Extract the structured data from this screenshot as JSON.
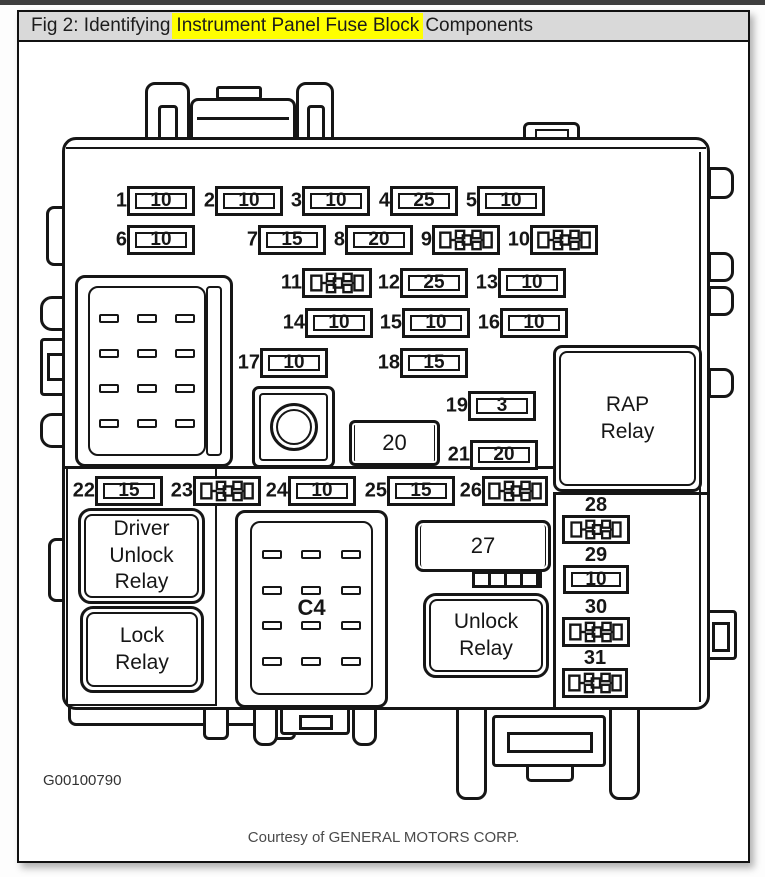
{
  "titlebar": {
    "prefix": "Fig 2: Identifying",
    "highlight": "Instrument Panel Fuse Block",
    "suffix": "Components",
    "highlight_color": "#ffff00"
  },
  "components": [
    {
      "num": "1",
      "amp": "10",
      "type": "fuse"
    },
    {
      "num": "2",
      "amp": "10",
      "type": "fuse"
    },
    {
      "num": "3",
      "amp": "10",
      "type": "fuse"
    },
    {
      "num": "4",
      "amp": "25",
      "type": "fuse"
    },
    {
      "num": "5",
      "amp": "10",
      "type": "fuse"
    },
    {
      "num": "6",
      "amp": "10",
      "type": "fuse"
    },
    {
      "num": "7",
      "amp": "15",
      "type": "fuse"
    },
    {
      "num": "8",
      "amp": "20",
      "type": "fuse"
    },
    {
      "num": "9",
      "type": "circuit-breaker"
    },
    {
      "num": "10",
      "type": "circuit-breaker"
    },
    {
      "num": "11",
      "type": "circuit-breaker"
    },
    {
      "num": "12",
      "amp": "25",
      "type": "fuse"
    },
    {
      "num": "13",
      "amp": "10",
      "type": "fuse"
    },
    {
      "num": "14",
      "amp": "10",
      "type": "fuse"
    },
    {
      "num": "15",
      "amp": "10",
      "type": "fuse"
    },
    {
      "num": "16",
      "amp": "10",
      "type": "fuse"
    },
    {
      "num": "17",
      "amp": "10",
      "type": "fuse"
    },
    {
      "num": "18",
      "amp": "15",
      "type": "fuse"
    },
    {
      "num": "19",
      "amp": "3",
      "type": "fuse"
    },
    {
      "num": "20",
      "type": "labeled-box"
    },
    {
      "num": "21",
      "amp": "20",
      "type": "fuse"
    },
    {
      "num": "22",
      "amp": "15",
      "type": "fuse"
    },
    {
      "num": "23",
      "type": "circuit-breaker"
    },
    {
      "num": "24",
      "amp": "10",
      "type": "fuse"
    },
    {
      "num": "25",
      "amp": "15",
      "type": "fuse"
    },
    {
      "num": "26",
      "type": "circuit-breaker"
    },
    {
      "num": "27",
      "type": "labeled-box"
    },
    {
      "num": "28",
      "type": "circuit-breaker"
    },
    {
      "num": "29",
      "amp": "10",
      "type": "fuse"
    },
    {
      "num": "30",
      "type": "circuit-breaker"
    },
    {
      "num": "31",
      "type": "circuit-breaker"
    }
  ],
  "labels": {
    "rap_relay": "RAP Relay",
    "driver_unlock_relay": "Driver Unlock Relay",
    "lock_relay": "Lock Relay",
    "unlock_relay": "Unlock Relay",
    "c4": "C4"
  },
  "footer": {
    "code": "G00100790",
    "courtesy": "Courtesy of GENERAL MOTORS CORP."
  },
  "colors": {
    "line": "#161616",
    "titlebar_bg": "#d9d9d9",
    "highlight": "#ffff00",
    "topbar": "#3e3e3e"
  }
}
